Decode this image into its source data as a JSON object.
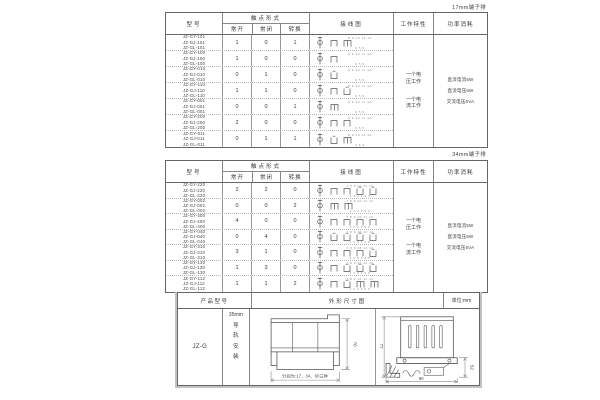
{
  "table_headers": {
    "model": "型号",
    "contact_form": "触点形式",
    "normally_open": "常开",
    "normally_closed": "常闭",
    "changeover": "转换",
    "wiring_diagram": "接线图",
    "working_characteristic": "工作特性",
    "power_consumption": "功率消耗"
  },
  "contact_tables": [
    {
      "caption": "17mm端子排",
      "working": [
        "一个电压工作",
        "一个电流工作"
      ],
      "power": [
        "直流电流5W",
        "直流电压5W",
        "交流电压5VA"
      ],
      "diagram_labels": {
        "top": "8 9 10 11 12",
        "bottom": "4 5 6"
      },
      "rows": [
        {
          "models": [
            "JZ-GY-101",
            "JZ-GJ-101",
            "JZ-GL-101"
          ],
          "no": "1",
          "nc": "0",
          "co": "1"
        },
        {
          "models": [
            "JZ-GY-100",
            "JZ-GJ-100",
            "JZ-GL-100"
          ],
          "no": "1",
          "nc": "0",
          "co": "0"
        },
        {
          "models": [
            "JZ-GY-010",
            "JZ-GJ-010",
            "JZ-GL-010"
          ],
          "no": "0",
          "nc": "1",
          "co": "0"
        },
        {
          "models": [
            "JZ-GY-110",
            "JZ-GJ-110",
            "JZ-GL-110"
          ],
          "no": "1",
          "nc": "1",
          "co": "0"
        },
        {
          "models": [
            "JZ-GY-001",
            "JZ-GJ-001",
            "JZ-GL-001"
          ],
          "no": "0",
          "nc": "0",
          "co": "1"
        },
        {
          "models": [
            "JZ-GY-200",
            "JZ-GJ-200",
            "JZ-GL-200"
          ],
          "no": "2",
          "nc": "0",
          "co": "0"
        },
        {
          "models": [
            "JZ-GY-011",
            "JZ-GJ-011",
            "JZ-GL-011"
          ],
          "no": "0",
          "nc": "1",
          "co": "1"
        }
      ]
    },
    {
      "caption": "34mm端子排",
      "working": [
        "一个电压工作",
        "一个电流工作"
      ],
      "power": [
        "直流电流5W",
        "直流电压5W",
        "交流电压5VA"
      ],
      "diagram_labels": {
        "top": "7 8 9 10 11 12",
        "bottom": "1 2 3 4 5 6"
      },
      "rows": [
        {
          "models": [
            "JZ-GY-220",
            "JZ-GJ-220",
            "JZ-GL-220"
          ],
          "no": "2",
          "nc": "2",
          "co": "0"
        },
        {
          "models": [
            "JZ-GY-002",
            "JZ-GJ-002",
            "JZ-GL-002"
          ],
          "no": "0",
          "nc": "0",
          "co": "2"
        },
        {
          "models": [
            "JZ-GY-400",
            "JZ-GJ-400",
            "JZ-GL-400"
          ],
          "no": "4",
          "nc": "0",
          "co": "0"
        },
        {
          "models": [
            "JZ-GY-040",
            "JZ-GJ-040",
            "JZ-GL-040"
          ],
          "no": "0",
          "nc": "4",
          "co": "0"
        },
        {
          "models": [
            "JZ-GY-310",
            "JZ-GJ-310",
            "JZ-GL-310"
          ],
          "no": "3",
          "nc": "1",
          "co": "0"
        },
        {
          "models": [
            "JZ-GY-130",
            "JZ-GJ-130",
            "JZ-GL-130"
          ],
          "no": "1",
          "nc": "3",
          "co": "0"
        },
        {
          "models": [
            "JZ-GY-112",
            "JZ-GJ-112",
            "JZ-GL-112"
          ],
          "no": "1",
          "nc": "1",
          "co": "2"
        }
      ]
    }
  ],
  "outline_table": {
    "headers": {
      "product_model": "产品型号",
      "outline_drawing": "外形尺寸图",
      "unit": "单位:mm"
    },
    "product_model": "JZ-G",
    "rail_size": "35mm",
    "mounting": "导轨安装",
    "front_view": {
      "height_dim": "70",
      "width_note": "分别为:17、34、60三种"
    },
    "side_view": {
      "height_dim": "77",
      "clip_dim": "52",
      "width_dim": "90"
    }
  }
}
